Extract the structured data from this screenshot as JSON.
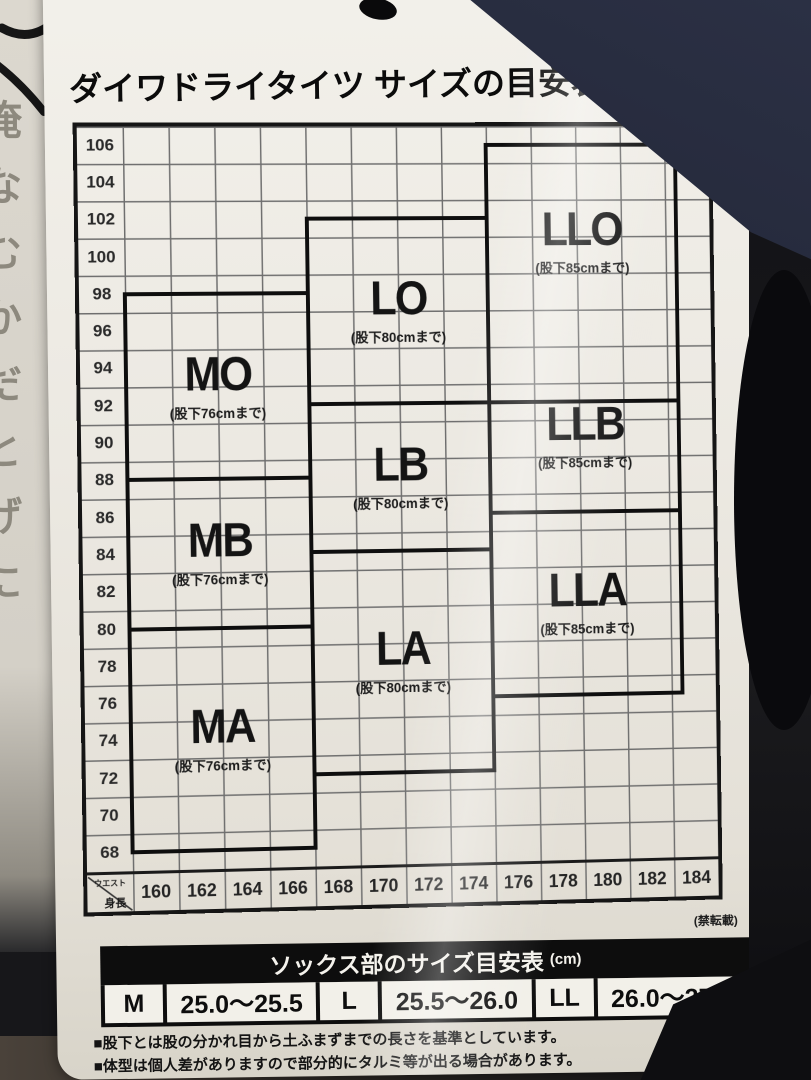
{
  "title": {
    "text": "ダイワドライタイツ サイズの目安表",
    "unit": "(単位:cm)"
  },
  "chart_data": {
    "type": "table",
    "title": "ダイワドライタイツ サイズの目安表",
    "unit": "cm",
    "x_axis": {
      "label": "身長",
      "values": [
        "160",
        "162",
        "164",
        "166",
        "168",
        "170",
        "172",
        "174",
        "176",
        "178",
        "180",
        "182",
        "184"
      ]
    },
    "y_axis": {
      "label": "ウエスト",
      "values": [
        "106",
        "104",
        "102",
        "100",
        "98",
        "96",
        "94",
        "92",
        "90",
        "88",
        "86",
        "84",
        "82",
        "80",
        "78",
        "76",
        "74",
        "72",
        "70",
        "68"
      ]
    },
    "x_range": [
      159,
      185
    ],
    "y_range": [
      67,
      107
    ],
    "grid": true,
    "regions": [
      {
        "name": "MO",
        "inseam": "(股下76cmまで)",
        "height_from": 159,
        "height_to": 167,
        "waist_from": 88,
        "waist_to": 98
      },
      {
        "name": "MB",
        "inseam": "(股下76cmまで)",
        "height_from": 159,
        "height_to": 167,
        "waist_from": 80,
        "waist_to": 88
      },
      {
        "name": "MA",
        "inseam": "(股下76cmまで)",
        "height_from": 159,
        "height_to": 167,
        "waist_from": 68,
        "waist_to": 80
      },
      {
        "name": "LO",
        "inseam": "(股下80cmまで)",
        "height_from": 167,
        "height_to": 175,
        "waist_from": 92,
        "waist_to": 102
      },
      {
        "name": "LB",
        "inseam": "(股下80cmまで)",
        "height_from": 167,
        "height_to": 175,
        "waist_from": 84,
        "waist_to": 92
      },
      {
        "name": "LA",
        "inseam": "(股下80cmまで)",
        "height_from": 167,
        "height_to": 175,
        "waist_from": 72,
        "waist_to": 84
      },
      {
        "name": "LLO",
        "inseam": "(股下85cmまで)",
        "height_from": 175,
        "height_to": 183.5,
        "waist_from": 92,
        "waist_to": 106,
        "label_dy": -32
      },
      {
        "name": "LLB",
        "inseam": "(股下85cmまで)",
        "height_from": 175,
        "height_to": 183.5,
        "waist_from": 86,
        "waist_to": 92,
        "label_dy": -20
      },
      {
        "name": "LLA",
        "inseam": "(股下85cmまで)",
        "height_from": 175,
        "height_to": 183.5,
        "waist_from": 76,
        "waist_to": 86
      }
    ],
    "note": "(禁転載)"
  },
  "socks_table": {
    "title": "ソックス部のサイズ目安表",
    "unit": "(cm)",
    "rows": [
      [
        "M",
        "25.0〜25.5"
      ],
      [
        "L",
        "25.5〜26.0"
      ],
      [
        "LL",
        "26.0〜27.0"
      ]
    ]
  },
  "footnotes": [
    "■股下とは股の分かれ目から土ふまずまでの長さを基準としています。",
    "■体型は個人差がありますので部分的にタルミ等が出る場合があります。"
  ],
  "neighbor_tag_glyphs": [
    "俺",
    "な",
    "む",
    "か",
    "だ",
    "と",
    "げ",
    "に"
  ],
  "colors": {
    "ink": "#111111",
    "tag_background": "#ece9e2",
    "navy_fabric": "#232a3c",
    "black_fabric": "#0e0e11"
  }
}
